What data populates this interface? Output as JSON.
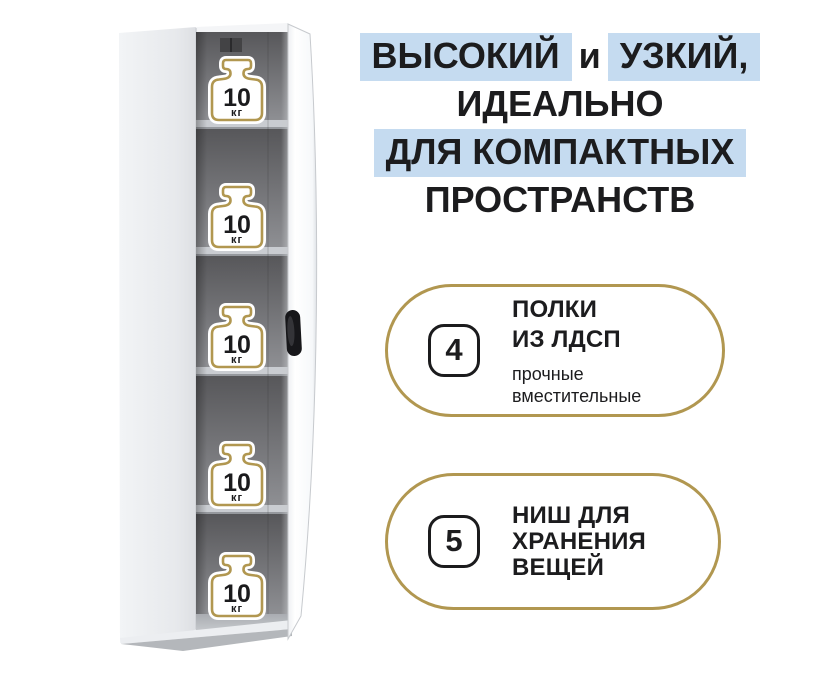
{
  "headline": {
    "line1_part1": "ВЫСОКИЙ",
    "line1_part2": "и",
    "line1_part3": "УЗКИЙ,",
    "line2": "ИДЕАЛЬНО",
    "line3": "ДЛЯ КОМПАКТНЫХ",
    "line4": "ПРОСТРАНСТВ"
  },
  "cabinet": {
    "niche_count": 5,
    "weight_value": "10",
    "weight_unit": "кг"
  },
  "features": [
    {
      "number": "4",
      "title_line1": "ПОЛКИ",
      "title_line2": "ИЗ ЛДСП",
      "sub_line1": "прочные",
      "sub_line2": "вместительные"
    },
    {
      "number": "5",
      "title_line1": "НИШ ДЛЯ",
      "title_line2": "ХРАНЕНИЯ",
      "title_line3": "ВЕЩЕЙ"
    }
  ],
  "colors": {
    "highlight_blue": "#c5dbf0",
    "accent_gold": "#b19750",
    "text_dark": "#1c1c1e",
    "background": "#ffffff"
  }
}
